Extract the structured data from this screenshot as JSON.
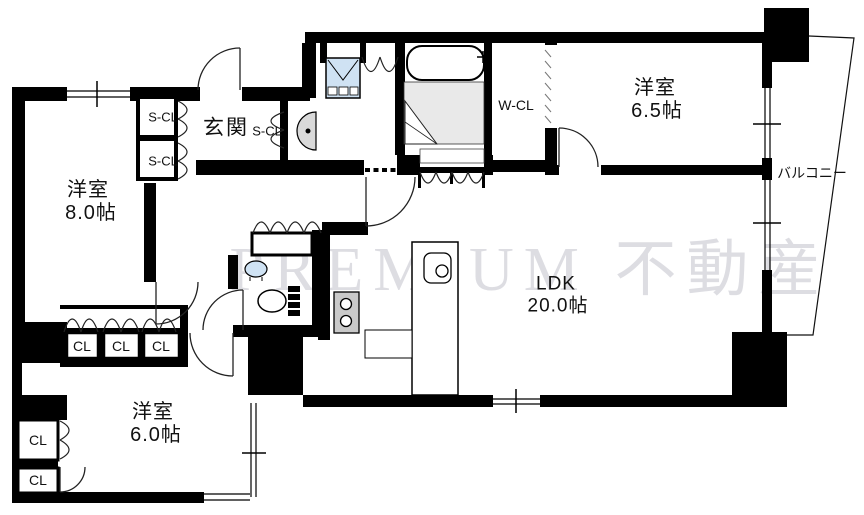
{
  "watermark": "PREMIUM 不動産",
  "rooms": {
    "western_room_8": {
      "name": "洋室",
      "size": "8.0帖"
    },
    "western_room_65": {
      "name": "洋室",
      "size": "6.5帖"
    },
    "western_room_6": {
      "name": "洋室",
      "size": "6.0帖"
    },
    "ldk": {
      "name": "LDK",
      "size": "20.0帖"
    },
    "entrance": {
      "name": "玄関"
    },
    "balcony": {
      "name": "バルコニー"
    }
  },
  "closets": {
    "shoe_closet_1": "S-CL",
    "shoe_closet_2": "S-CL",
    "shoe_closet_3": "S-CL",
    "walk_in_closet": "W-CL",
    "closet_row_1": "CL",
    "closet_row_2": "CL",
    "closet_row_3": "CL",
    "closet_col_1": "CL",
    "closet_col_2": "CL"
  },
  "colors": {
    "wall": "#000000",
    "bath_floor": "#e9e9e9",
    "laundry_blue": "#cfe2f3",
    "fixture_gray": "#d9d9d9",
    "watermark_gray": "#c7c7d0"
  }
}
